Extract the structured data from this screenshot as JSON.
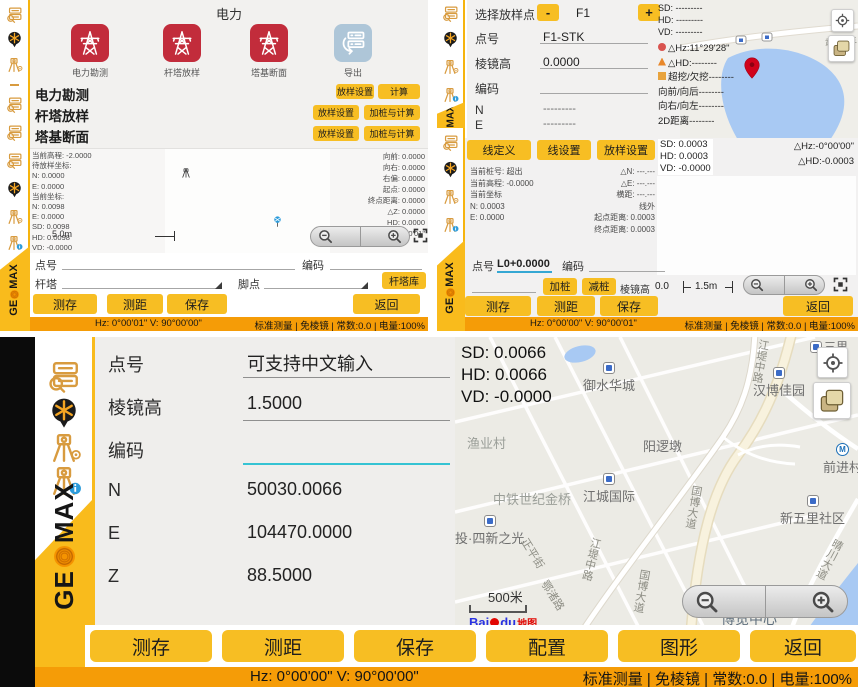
{
  "colors": {
    "accent_yellow": "#F7BE23",
    "status_orange": "#F59C07",
    "tile_red": "#C22C3B",
    "tile_blue": "#AEC6D8",
    "sidebar_orange": "#D89B3F",
    "teal_underline": "#35C3D3",
    "map_water": "#A8C9F3"
  },
  "brand": {
    "ge": "GE",
    "max": "MAX"
  },
  "tl_menu": {
    "title": "电力",
    "tiles": [
      {
        "label": "电力勘测"
      },
      {
        "label": "杆塔放样"
      },
      {
        "label": "塔基断面"
      },
      {
        "label": "导出"
      }
    ],
    "rows": [
      {
        "label": "电力勘测",
        "btn1": "放样设置",
        "btn2": "计算"
      },
      {
        "label": "杆塔放样",
        "btn1": "放样设置",
        "btn2": "加桩与计算"
      },
      {
        "label": "塔基断面",
        "btn1": "放样设置",
        "btn2": "加桩与计算"
      }
    ]
  },
  "tl_survey": {
    "left_readouts": [
      "当前高程: -2.0000",
      "待放样坐标:",
      "N: 0.0000",
      "E: 0.0000",
      "当前坐标:",
      "N: 0.0098",
      "E: 0.0000",
      "SD: 0.0098",
      "HD: 0.0098",
      "VD: -0.0000"
    ],
    "right_readouts": [
      "向前: 0.0000",
      "向右: 0.0000",
      "右偏: 0.0000",
      "起点: 0.0000",
      "终点距离: 0.0000",
      "△Z: 0.0000",
      "HD: 0.0000",
      "△Hz:-0°00'01\""
    ],
    "scale": "5.0m",
    "point_label": "点号",
    "code_label": "编码",
    "tower_label": "杆塔",
    "foot_label": "脚点",
    "tower_lib_btn": "杆塔库",
    "btn_measure_save": "测存",
    "btn_measure_dist": "测距",
    "btn_save": "保存",
    "btn_back": "返回",
    "status_left": "Hz: 0°00'01\"  V: 90°00'00\"",
    "status_right": "标准测量 | 免棱镜 | 常数:0.0 | 电量:100%"
  },
  "tr_stakeout": {
    "select_label": "选择放样点",
    "minus": "-",
    "value": "F1",
    "plus": "+",
    "fields": [
      {
        "label": "点号",
        "value": "F1-STK"
      },
      {
        "label": "棱镜高",
        "value": "0.0000"
      },
      {
        "label": "编码",
        "value": ""
      },
      {
        "label": "N",
        "value": "---------"
      },
      {
        "label": "E",
        "value": "---------"
      }
    ],
    "readouts_plain": [
      "SD: ---------",
      "HD: ---------",
      "VD: ---------"
    ],
    "readouts_icon": [
      "△Hz:11°29'28\"",
      "△HD:--------",
      "超挖/欠挖--------",
      "向前/向后--------",
      "向右/向左--------",
      "2D距离--------"
    ],
    "map_road_label": "武大园三"
  },
  "tr_line": {
    "btn_line_def": "线定义",
    "btn_line_set": "线设置",
    "btn_stake_set": "放样设置",
    "sd_readouts": [
      "SD: 0.0003",
      "HD: 0.0003",
      "VD: -0.0000"
    ],
    "delta_readouts": [
      "△Hz:-0°00'00\"",
      "△HD:-0.0003"
    ],
    "left_readouts": [
      "当前桩号: 超出",
      "当前高程: -0.0000",
      "当前坐标",
      "N: 0.0003",
      "E: 0.0000"
    ],
    "mid_readouts": [
      "△N: ---.---",
      "△E: ---.---",
      "横距: ---.---",
      "线外",
      "起点距离: 0.0003",
      "终点距离: 0.0003"
    ],
    "point_label": "点号",
    "point_value": "L0+0.0000",
    "code_label": "编码",
    "btn_add_stake": "加桩",
    "btn_sub_stake": "减桩",
    "prism_label": "棱镜高",
    "prism_value": "0.0",
    "scale": "1.5m",
    "btn_measure_save": "测存",
    "btn_measure_dist": "测距",
    "btn_save": "保存",
    "btn_back": "返回",
    "status_left": "Hz: 0°00'00\"  V: 90°00'01\"",
    "status_right": "标准测量 | 免棱镜 | 常数:0.0 | 电量:100%"
  },
  "measure": {
    "fields": [
      {
        "label": "点号",
        "value": "可支持中文输入"
      },
      {
        "label": "棱镜高",
        "value": "1.5000"
      },
      {
        "label": "编码",
        "value": ""
      },
      {
        "label": "N",
        "value": "50030.0066"
      },
      {
        "label": "E",
        "value": "104470.0000"
      },
      {
        "label": "Z",
        "value": "88.5000"
      }
    ],
    "buttons": [
      "测存",
      "测距",
      "保存",
      "配置",
      "图形",
      "返回"
    ],
    "status_left": "Hz: 0°00'00\"  V: 90°00'00\"",
    "status_right": "标准测量 | 免棱镜 | 常数:0.0 | 电量:100%",
    "map": {
      "readouts": [
        "SD: 0.0066",
        "HD: 0.0066",
        "VD: -0.0000"
      ],
      "scale": "500米",
      "metro_letter": "M",
      "baidu": {
        "bai": "Bai",
        "du": "du",
        "map_word": "地图"
      },
      "labels": [
        {
          "text": "三里",
          "kind": "bus"
        },
        {
          "text": "江堤中路",
          "kind": "road"
        },
        {
          "text": "御水华城",
          "kind": "bus"
        },
        {
          "text": "汉博佳园",
          "kind": "bus"
        },
        {
          "text": "渔业村",
          "kind": "area"
        },
        {
          "text": "阳逻墩",
          "kind": "area"
        },
        {
          "text": "前进村",
          "kind": "metro"
        },
        {
          "text": "中铁世纪金桥",
          "kind": "area"
        },
        {
          "text": "江城国际",
          "kind": "bus"
        },
        {
          "text": "新五里社区",
          "kind": "bus"
        },
        {
          "text": "投·四新之光",
          "kind": "bus"
        },
        {
          "text": "正平街",
          "kind": "road"
        },
        {
          "text": "江堤中路",
          "kind": "road"
        },
        {
          "text": "鄂渚路",
          "kind": "road"
        },
        {
          "text": "国博大道",
          "kind": "road"
        },
        {
          "text": "国博大道",
          "kind": "road"
        },
        {
          "text": "晴川大道",
          "kind": "road"
        },
        {
          "text": "博览中心",
          "kind": "area"
        }
      ]
    }
  }
}
